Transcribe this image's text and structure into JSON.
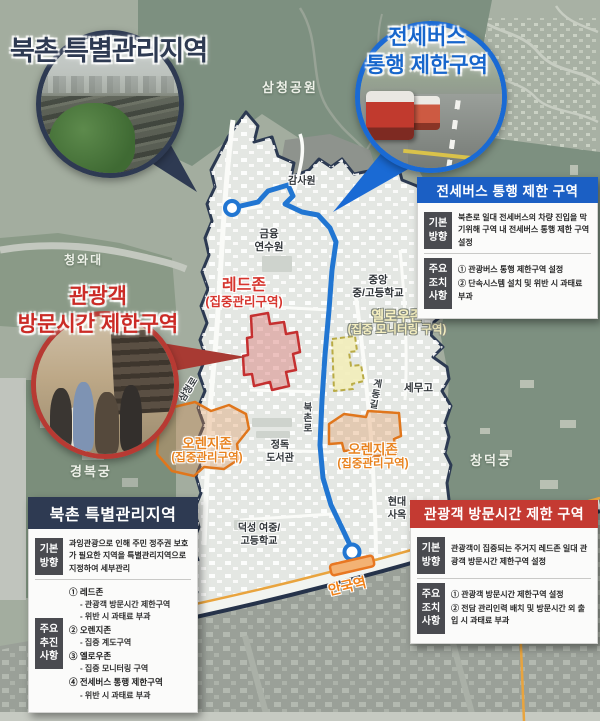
{
  "colors": {
    "navy": "#2e3a52",
    "blue": "#1a6ad4",
    "red": "#c43a32",
    "orange": "#e8821e",
    "route_blue": "#2176d2"
  },
  "callouts": {
    "bukchon_title": "북촌 특별관리지역",
    "bus_title_line1": "전세버스",
    "bus_title_line2": "통행 제한구역",
    "tourist_title_line1": "관광객",
    "tourist_title_line2": "방문시간 제한구역"
  },
  "zones": {
    "red": {
      "name": "레드존",
      "desc": "(집중관리구역)"
    },
    "yellow": {
      "name": "옐로우존",
      "desc": "(집중 모니터링 구역)"
    },
    "orange_left": {
      "name": "오렌지존",
      "desc": "(집중관리구역)"
    },
    "orange_right": {
      "name": "오렌지존",
      "desc": "(집중관리구역)"
    }
  },
  "places": {
    "samcheong_park": "삼청공원",
    "gamsawon": "감사원",
    "geumyung_line1": "금융",
    "geumyung_line2": "연수원",
    "cheongwadae": "청와대",
    "jungang_line1": "중앙",
    "jungang_line2": "중/고등학교",
    "semugo": "세무고",
    "changdeokgung": "창덕궁",
    "gyeongbokgung": "경복궁",
    "jeongdok_line1": "정독",
    "jeongdok_line2": "도서관",
    "deoksung_line1": "덕성 여중/",
    "deoksung_line2": "고등학교",
    "hyundai_line1": "현대",
    "hyundai_line2": "사옥",
    "samcheongro": "삼청로",
    "bukchonro": "북촌로",
    "gyedonggil": "계동길",
    "anguk": "안국역"
  },
  "boxes": {
    "bus": {
      "header": "전세버스 통행 제한 구역",
      "basic_label": "기본방향",
      "basic_text": "북촌로 일대 전세버스의 차량 진입을 막기위해 구역 내 전세버스 통행 제한 구역 설정",
      "major_label": "주요조치사항",
      "items": [
        "① 관광버스 통행 제한구역 설정",
        "② 단속시스템 설치 및 위반 시 과태료 부과"
      ]
    },
    "bukchon": {
      "header": "북촌 특별관리지역",
      "basic_label": "기본방향",
      "basic_text": "과잉관광으로 인해 주민 정주권 보호가 필요한 지역을 특별관리지역으로 지정하여 세부관리",
      "major_label": "주요추진사항",
      "items": [
        {
          "title": "① 레드존",
          "subs": [
            "- 관광객 방문시간 제한구역",
            "- 위반 시 과태료 부과"
          ]
        },
        {
          "title": "② 오렌지존",
          "subs": [
            "- 집중 계도구역"
          ]
        },
        {
          "title": "③ 옐로우존",
          "subs": [
            "- 집중 모니터링 구역"
          ]
        },
        {
          "title": "④ 전세버스 통행 제한구역",
          "subs": [
            "- 위반 시 과태료 부과"
          ]
        }
      ]
    },
    "tourist": {
      "header": "관광객 방문시간 제한 구역",
      "basic_label": "기본방향",
      "basic_text": "관광객이 집중되는 주거지 레드존 일대 관광객 방문시간 제한구역 설정",
      "major_label": "주요조치사항",
      "items": [
        "① 관광객 방문시간 제한구역 설정",
        "② 전담 관리인력 배치 및 방문시간 외 출입 시 과태료 부과"
      ]
    }
  }
}
